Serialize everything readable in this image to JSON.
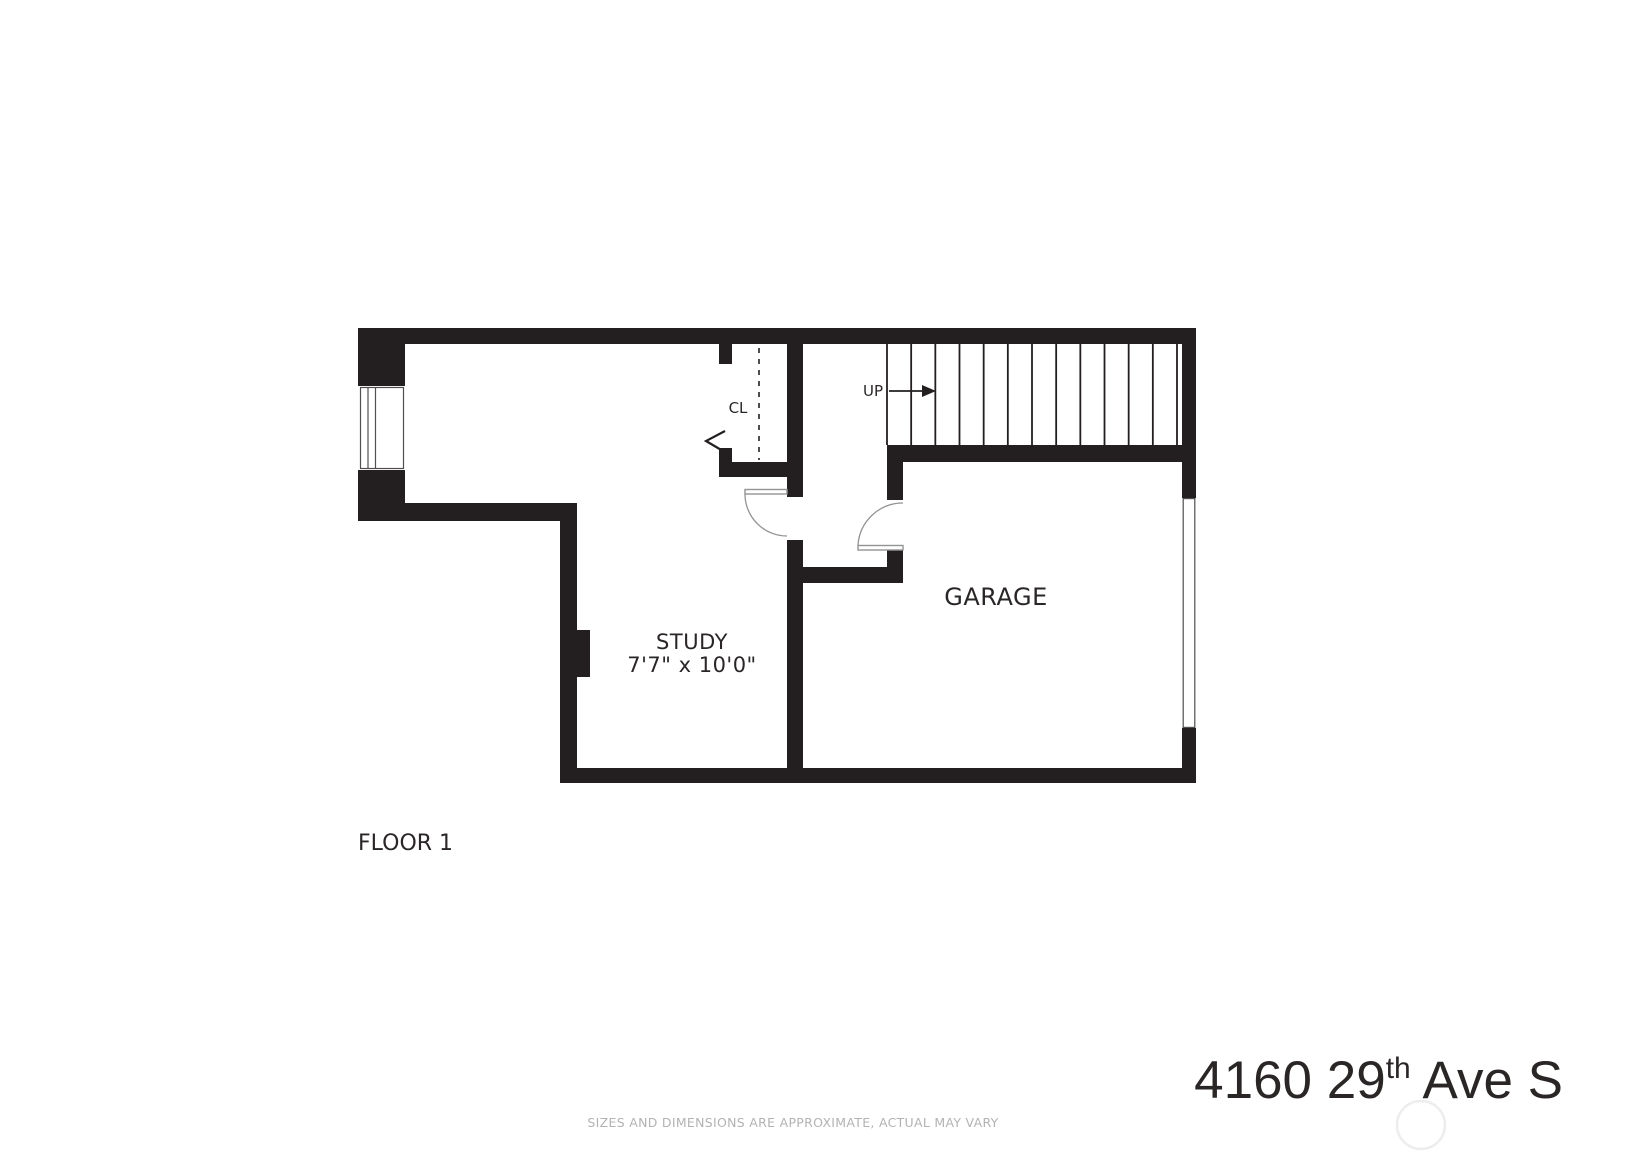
{
  "colors": {
    "wall": "#231f20",
    "label": "#2a2626",
    "door": "#939393",
    "muted": "#b3b3b3",
    "watermark": "#ededed"
  },
  "floor_plan": {
    "floor_label": "FLOOR 1",
    "rooms": [
      {
        "name": "STUDY",
        "dimensions": "7'7\" x 10'0\""
      },
      {
        "name": "GARAGE"
      }
    ],
    "closet_label": "CL",
    "stairs": {
      "label": "UP",
      "tread_count": 13
    }
  },
  "footer": {
    "address": {
      "full": "4160 29th Ave S",
      "prefix": "4160 29",
      "superscript": "th",
      "suffix": " Ave S"
    },
    "disclaimer": "SIZES AND DIMENSIONS ARE APPROXIMATE, ACTUAL MAY VARY"
  }
}
